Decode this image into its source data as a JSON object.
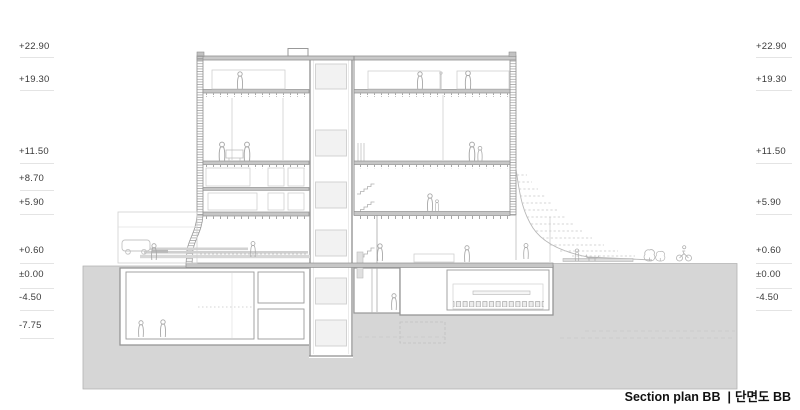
{
  "caption": {
    "text_en": "Section plan BB",
    "separator": "|",
    "text_ko": "단면도 BB"
  },
  "elevation_markers": {
    "left": [
      {
        "label": "+22.90",
        "text_top": 41,
        "line_y": 57
      },
      {
        "label": "+19.30",
        "text_top": 74,
        "line_y": 90
      },
      {
        "label": "+11.50",
        "text_top": 146,
        "line_y": 163
      },
      {
        "label": "+8.70",
        "text_top": 173,
        "line_y": 190
      },
      {
        "label": "+5.90",
        "text_top": 197,
        "line_y": 214
      },
      {
        "label": "+0.60",
        "text_top": 245,
        "line_y": 263
      },
      {
        "label": "±0.00",
        "text_top": 269,
        "line_y": 288
      },
      {
        "label": "-4.50",
        "text_top": 292,
        "line_y": 310
      },
      {
        "label": "-7.75",
        "text_top": 320,
        "line_y": 338
      }
    ],
    "right": [
      {
        "label": "+22.90",
        "text_top": 41,
        "line_y": 57
      },
      {
        "label": "+19.30",
        "text_top": 74,
        "line_y": 90
      },
      {
        "label": "+11.50",
        "text_top": 146,
        "line_y": 163
      },
      {
        "label": "+5.90",
        "text_top": 197,
        "line_y": 214
      },
      {
        "label": "+0.60",
        "text_top": 245,
        "line_y": 263
      },
      {
        "label": "±0.00",
        "text_top": 269,
        "line_y": 288
      },
      {
        "label": "-4.50",
        "text_top": 292,
        "line_y": 310
      }
    ]
  },
  "colors": {
    "ground": "#d6d6d6",
    "slab": "#c6c6c6",
    "wall_line": "#8f8f8f",
    "light_line": "#d0d0d0",
    "figure_line": "#a8a8a8",
    "leader_line": "#e4e4e4",
    "label_text": "#3a3a3a",
    "caption_text": "#111111"
  },
  "figures": [
    {
      "type": "person-figure",
      "x": 240,
      "y": 89,
      "s": 1
    },
    {
      "type": "person-figure",
      "x": 420,
      "y": 89,
      "s": 1
    },
    {
      "type": "person-figure",
      "x": 468,
      "y": 89,
      "s": 1.05
    },
    {
      "type": "person-figure",
      "x": 222,
      "y": 161,
      "s": 1.1
    },
    {
      "type": "person-figure",
      "x": 247,
      "y": 161,
      "s": 1.1
    },
    {
      "type": "person-figure",
      "x": 472,
      "y": 161,
      "s": 1.1
    },
    {
      "type": "person-figure",
      "x": 480,
      "y": 161,
      "s": 0.85
    },
    {
      "type": "person-figure",
      "x": 430,
      "y": 211,
      "s": 1
    },
    {
      "type": "person-figure",
      "x": 437,
      "y": 211,
      "s": 0.65
    },
    {
      "type": "person-figure",
      "x": 154,
      "y": 260,
      "s": 0.95
    },
    {
      "type": "person-figure",
      "x": 253,
      "y": 257,
      "s": 0.9
    },
    {
      "type": "person-figure",
      "x": 380,
      "y": 261,
      "s": 1
    },
    {
      "type": "person-figure",
      "x": 467,
      "y": 262,
      "s": 0.95
    },
    {
      "type": "person-figure",
      "x": 526,
      "y": 259,
      "s": 0.9
    },
    {
      "type": "person-figure",
      "x": 577,
      "y": 261,
      "s": 0.7
    },
    {
      "type": "dog-figure",
      "x": 589,
      "y": 261,
      "s": 1
    },
    {
      "type": "shrub-figure",
      "x": 648,
      "y": 261,
      "s": 1
    },
    {
      "type": "shrub-figure",
      "x": 659,
      "y": 261,
      "s": 0.85
    },
    {
      "type": "bicycle-figure",
      "x": 684,
      "y": 261,
      "s": 1
    },
    {
      "type": "car-figure",
      "x": 136,
      "y": 254,
      "s": 1
    },
    {
      "type": "person-figure",
      "x": 141,
      "y": 337,
      "s": 0.95
    },
    {
      "type": "person-figure",
      "x": 163,
      "y": 337,
      "s": 1
    },
    {
      "type": "person-figure",
      "x": 394,
      "y": 310,
      "s": 0.95
    }
  ]
}
